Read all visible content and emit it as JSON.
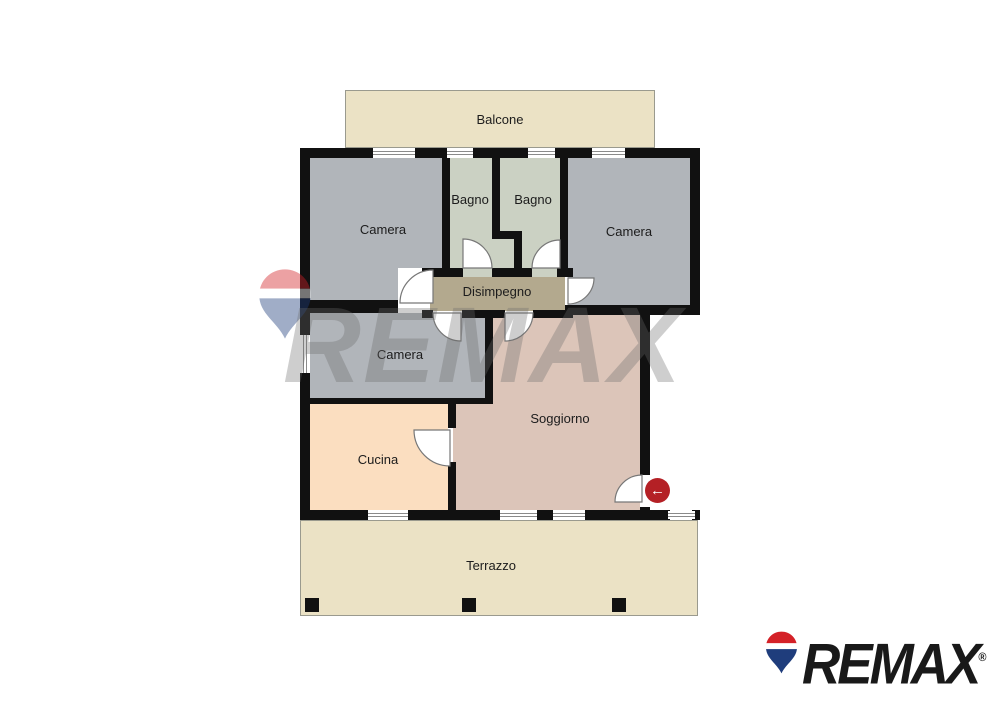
{
  "plan": {
    "rooms": [
      {
        "id": "balcone",
        "label": "Balcone"
      },
      {
        "id": "camera-tl",
        "label": "Camera"
      },
      {
        "id": "bagno-1",
        "label": "Bagno"
      },
      {
        "id": "bagno-2",
        "label": "Bagno"
      },
      {
        "id": "camera-tr",
        "label": "Camera"
      },
      {
        "id": "disimpegno",
        "label": "Disimpegno"
      },
      {
        "id": "camera-mid",
        "label": "Camera"
      },
      {
        "id": "soggiorno",
        "label": "Soggiorno"
      },
      {
        "id": "cucina",
        "label": "Cucina"
      },
      {
        "id": "terrazzo",
        "label": "Terrazzo"
      }
    ],
    "entrance": {
      "icon": "arrow-left-icon",
      "glyph": "←"
    },
    "colors": {
      "wall": "#111111",
      "camera": "#b1b5ba",
      "bagno": "#cbd1c3",
      "disimpegno": "#b3a98e",
      "soggiorno": "#dcc5b9",
      "cucina": "#fbdec0",
      "balcone_terrazzo": "#ebe2c5",
      "arrow_button_red": "#b42025",
      "watermark_gray": "#6a6a6a",
      "remax_red": "#d42127",
      "remax_blue": "#1f3d7c"
    }
  },
  "watermark": {
    "text": "REMAX"
  },
  "logo": {
    "text": "REMAX",
    "registered": "®"
  }
}
